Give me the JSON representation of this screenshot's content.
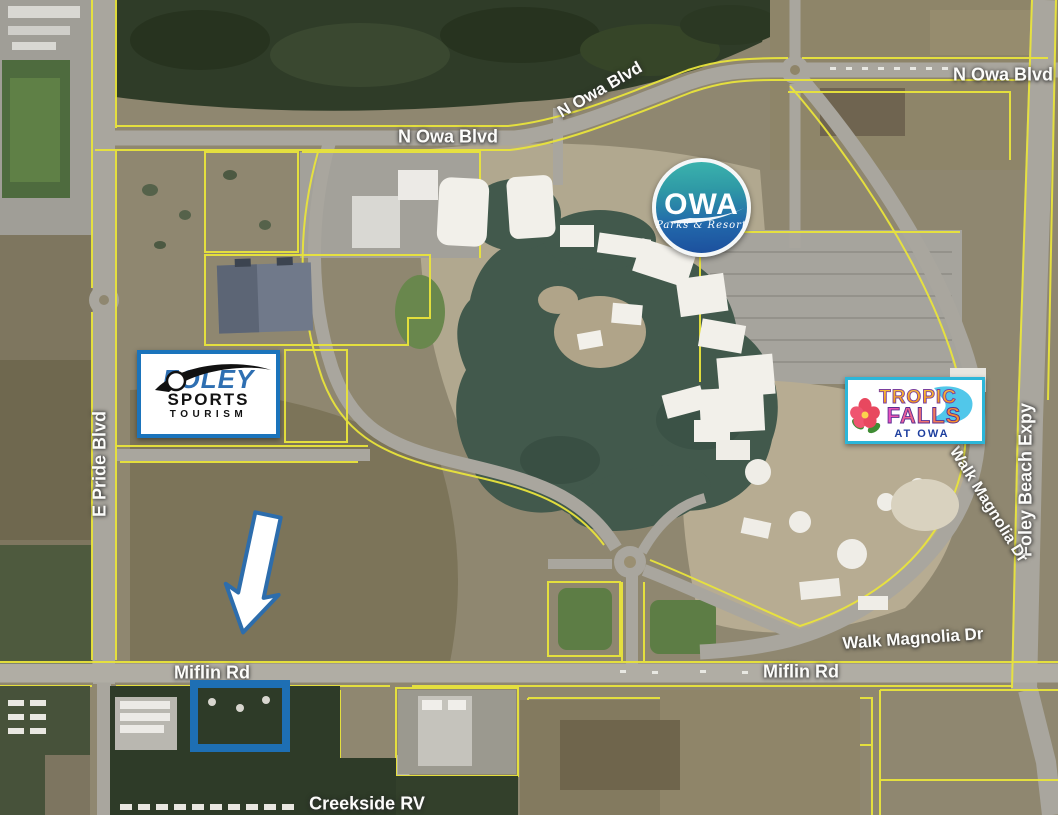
{
  "map": {
    "road_labels": {
      "n_owa_blvd_west": "N Owa Blvd",
      "n_owa_blvd_curve": "N Owa Blvd",
      "n_owa_blvd_east": "N Owa Blvd",
      "e_pride_blvd": "E Pride Blvd",
      "foley_beach_expy": "Foley Beach Expy",
      "walk_magnolia_dr_north": "Walk Magnolia Dr",
      "walk_magnolia_dr_south": "Walk Magnolia Dr",
      "miflin_rd_west": "Miflin Rd",
      "miflin_rd_east": "Miflin Rd"
    },
    "place_labels": {
      "creekside_rv": "Creekside RV"
    },
    "logos": {
      "owa": {
        "name": "OWA",
        "tagline": "Parks & Resort"
      },
      "foley_sports": {
        "line1": "FOLEY",
        "line2": "SPORTS",
        "line3": "TOURISM"
      },
      "tropic_falls": {
        "line1": "TROPIC",
        "line2": "FALLS",
        "line3": "AT OWA"
      }
    },
    "colors": {
      "parcel_line": "#e9e43c",
      "road_gray": "#a9a69e",
      "forest_green": "#2f3c28",
      "lake_teal": "#42594c",
      "highlight_box_blue": "#1e6fb4",
      "arrow_fill": "#ffffff",
      "arrow_outline": "#2d6dac",
      "owa_logo_teal": "#3bb3ad",
      "owa_logo_blue": "#1c4f9d",
      "foley_border_blue": "#1b74bc",
      "tropic_border_cyan": "#2cb6d9"
    }
  }
}
